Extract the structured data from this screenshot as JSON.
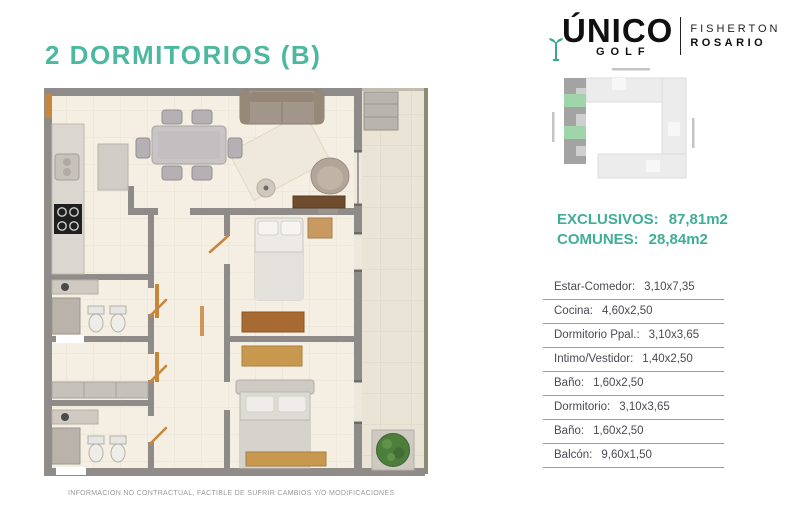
{
  "page": {
    "title": "2 DORMITORIOS (B)",
    "disclaimer": "INFORMACION NO CONTRACTUAL, FACTIBLE DE SUFRIR CAMBIOS Y/O MODIFICACIONES"
  },
  "brand": {
    "name": "ÚNICO",
    "sub": "GOLF",
    "location_line1": "FISHERTON",
    "location_line2": "ROSARIO",
    "tee_icon": "golf-tee-icon",
    "accent": "#3aa88f"
  },
  "areas": {
    "exclusivos_label": "EXCLUSIVOS:",
    "exclusivos_value": "87,81m2",
    "comunes_label": "COMUNES:",
    "comunes_value": "28,84m2",
    "color": "#3fae96"
  },
  "rooms": [
    {
      "label": "Estar-Comedor:",
      "value": "3,10x7,35"
    },
    {
      "label": "Cocina:",
      "value": "4,60x2,50"
    },
    {
      "label": "Dormitorio Ppal.:",
      "value": "3,10x3,65"
    },
    {
      "label": "Intimo/Vestidor:",
      "value": "1,40x2,50"
    },
    {
      "label": "Baño:",
      "value": "1,60x2,50"
    },
    {
      "label": "Dormitorio:",
      "value": "3,10x3,65"
    },
    {
      "label": "Baño:",
      "value": "1,60x2,50"
    },
    {
      "label": "Balcón:",
      "value": "9,60x1,50"
    }
  ],
  "plan_colors": {
    "wall": "#8f8b88",
    "floor": "#f4efe2",
    "balcony_floor": "#e9e4d6",
    "railing": "#8c8c72",
    "wood_accent": "#c8863c",
    "plant_green": "#4e7e3c",
    "title_teal": "#4cb89f",
    "siteplan_unit_green": "#9fd6a9"
  }
}
